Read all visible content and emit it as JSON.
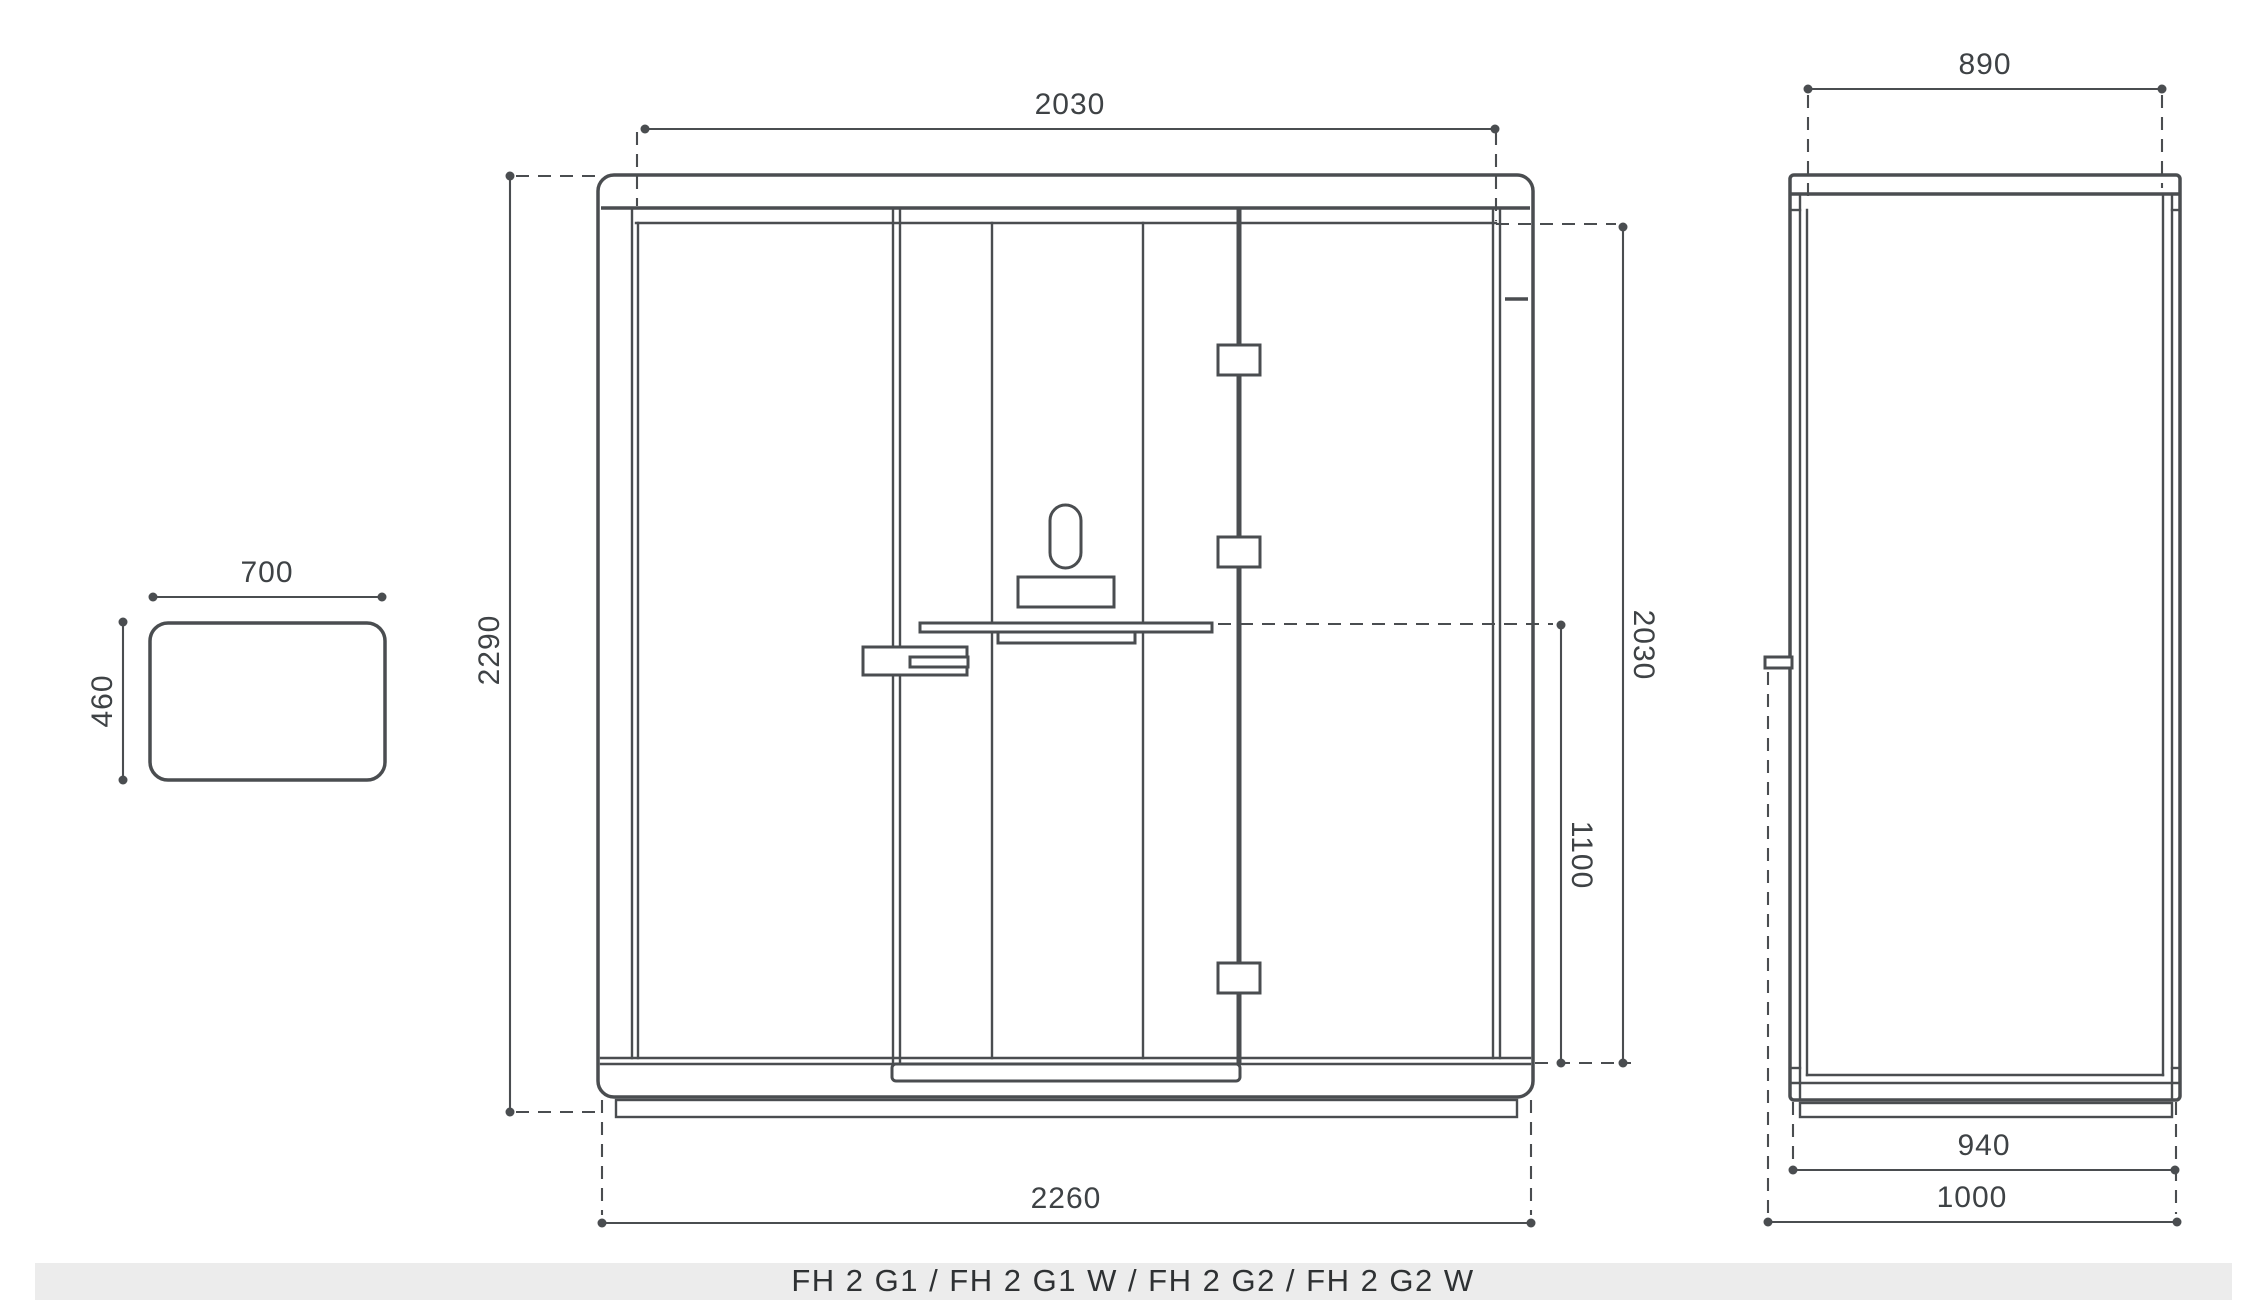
{
  "caption": "FH 2 G1 / FH 2 G1 W / FH 2 G2 / FH 2 G2 W",
  "views": {
    "table_top": {
      "width": "700",
      "depth": "460"
    },
    "front": {
      "inner_width_top": "2030",
      "overall_height": "2290",
      "interior_height": "2030",
      "table_height": "1100",
      "overall_width": "2260"
    },
    "side": {
      "inner_depth_top": "890",
      "body_depth": "940",
      "overall_depth": "1000"
    }
  },
  "colors": {
    "line": "#4a4d50",
    "text": "#3e4245",
    "caption_band": "#ececec",
    "background": "#ffffff"
  }
}
